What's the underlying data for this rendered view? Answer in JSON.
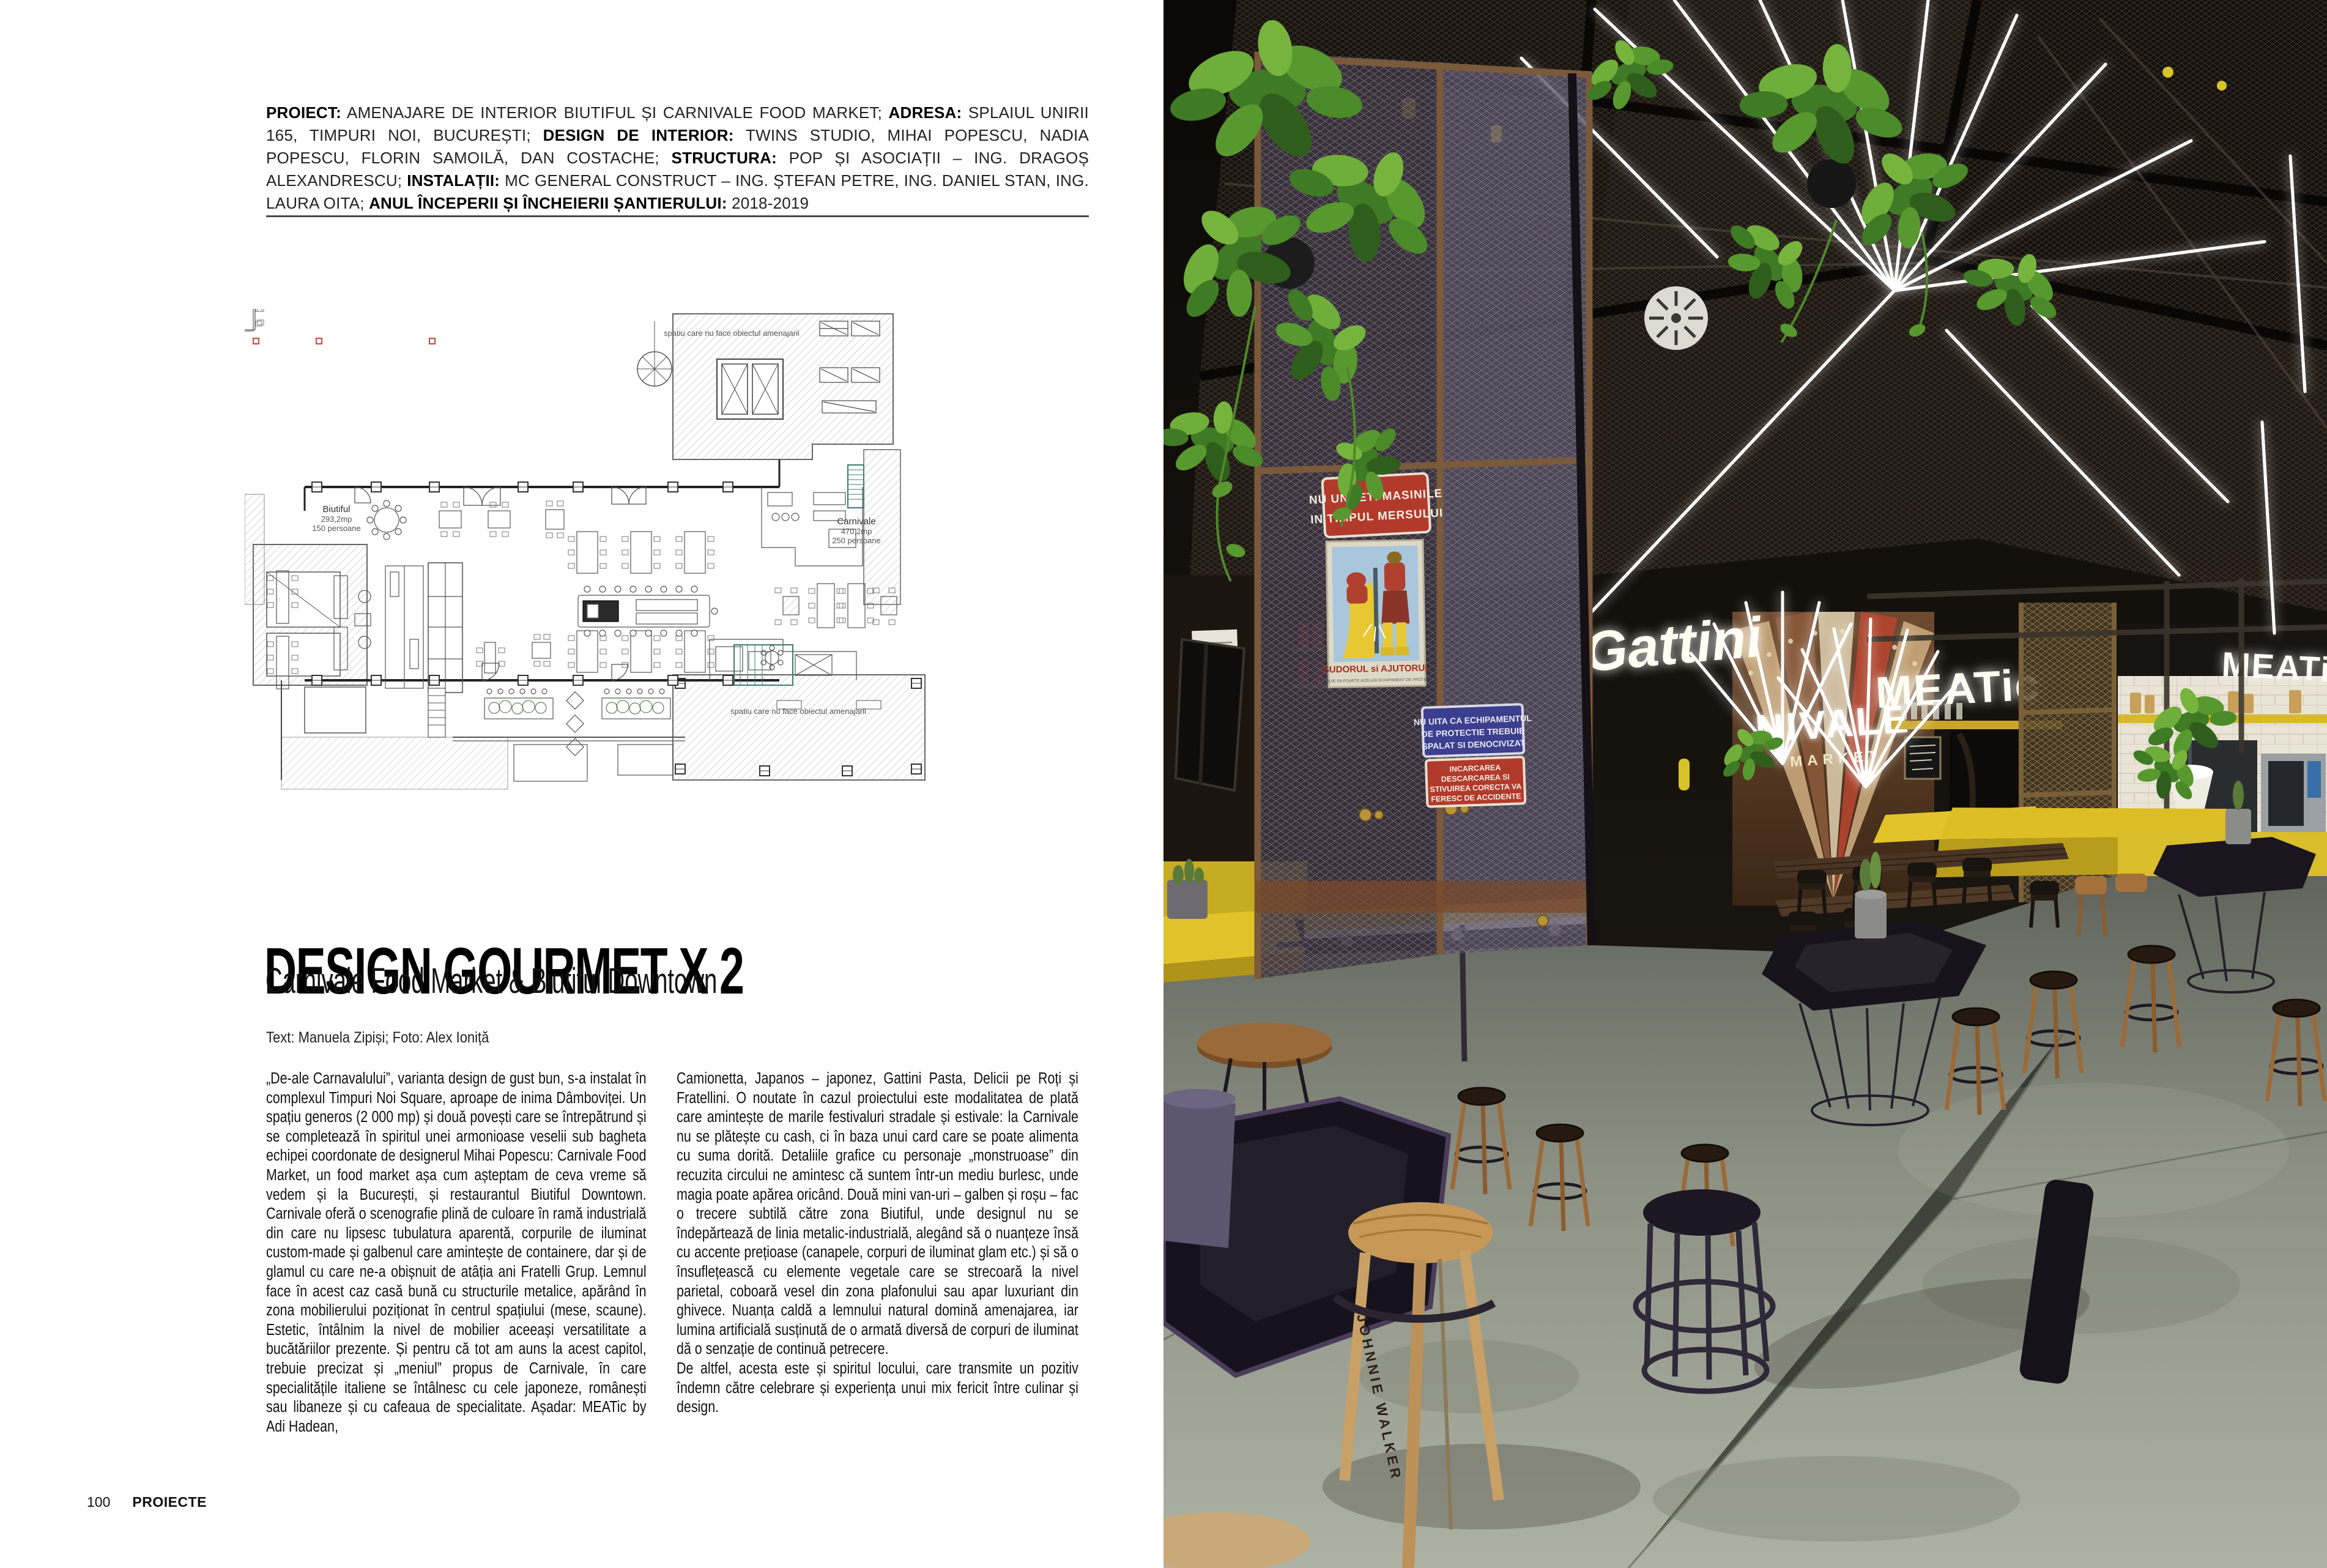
{
  "article": {
    "credits": {
      "segments": [
        {
          "label": "PROIECT:",
          "value": " AMENAJARE DE INTERIOR  BIUTIFUL ȘI CARNIVALE FOOD MARKET; "
        },
        {
          "label": "ADRESA:",
          "value": " SPLAIUL UNIRII 165, TIMPURI NOI, BUCUREȘTI; "
        },
        {
          "label": "DESIGN DE INTERIOR:",
          "value": " TWINS STUDIO, MIHAI POPESCU, NADIA POPESCU, FLORIN SAMOILĂ, DAN COSTACHE; "
        },
        {
          "label": "STRUCTURA:",
          "value": " POP ȘI ASOCIAȚII – ING. DRAGOȘ ALEXANDRESCU; "
        },
        {
          "label": "INSTALAȚII:",
          "value": " MC GENERAL CONSTRUCT – ING. ȘTEFAN PETRE, ING. DANIEL STAN, ING. LAURA OITA; "
        },
        {
          "label": "ANUL ÎNCEPERII ȘI ÎNCHEIERII ȘANTIERULUI:",
          "value": " 2018-2019"
        }
      ]
    },
    "title": "DESIGN GOURMET X 2",
    "subtitle": "Carnivale Food Market & Biutiful Downtown",
    "byline": "Text: Manuela Zipiși; Foto: Alex Ioniță",
    "body": {
      "col1": "„De-ale Carnavalului”, varianta design de gust bun, s-a instalat în complexul Timpuri Noi Square, aproape de inima Dâmboviței. Un spațiu generos (2 000 mp) și două povești care se întrepătrund și se completează în spiritul unei armonioase veselii sub bagheta echipei coordonate de designerul Mihai Popescu: Carnivale Food Market, un food market așa cum așteptam de ceva vreme să vedem și la București, și restaurantul Biutiful Downtown. Carnivale oferă o scenografie plină de culoare în ramă industrială din care nu lipsesc tubulatura aparentă, corpurile de iluminat custom-made și galbenul care amintește de containere, dar și de glamul cu care ne-a obișnuit de atâția ani Fratelli Grup. Lemnul face în acest caz casă bună cu structurile metalice, apărând în zona mobilierului poziționat în centrul spațiului (mese, scaune). Estetic, întâlnim la nivel de mobilier aceeași versatilitate a bucătăriilor prezente. Și pentru că tot am auns la acest capitol, trebuie precizat și „meniul” propus de Carnivale, în care specialitățile italiene se întâlnesc cu cele japoneze, românești sau libaneze și cu cafeaua de specialitate. Așadar: MEATic by Adi Hadean,",
      "col2": "Camionetta, Japanos – japonez, Gattini Pasta, Delicii pe Roți și Fratellini. O noutate în cazul proiectului este modalitatea de plată care amintește de marile festivaluri stradale și estivale: la Carnivale nu se plătește cu cash, ci în baza unui card care se poate alimenta cu suma dorită. Detaliile grafice cu personaje „monstruoase” din recuzita circului ne amintesc că suntem într-un mediu burlesc, unde magia poate apărea oricând. Două mini van-uri – galben și roșu – fac o trecere subtilă către zona Biutiful, unde designul nu se îndepărtează de linia metalic-industrială, alegând să o nuanțeze însă cu accente prețioase (canapele, corpuri de iluminat glam etc.) și să o însuflețească cu elemente vegetale care se strecoară la nivel parietal, coboară vesel din zona plafonului sau apar luxuriant din ghivece. Nuanța caldă a lemnului natural domină amenajarea, iar lumina artificială susținută de o armată diversă de corpuri de iluminat dă o senzație de continuă petrecere.\nDe altfel, acesta este și spiritul locului, care transmite un pozitiv îndemn către celebrare și experiența unui mix fericit între culinar și design."
    },
    "footer": {
      "page_number": "100",
      "section": "PROIECTE"
    }
  },
  "plan": {
    "labels": {
      "out_of_scope": "spatiu care nu face obiectul amenajarii",
      "biutiful_name": "Biutiful",
      "biutiful_area": "293,2mp",
      "biutiful_cap": "150 persoane",
      "carnivale_name": "Carnivale",
      "carnivale_area": "470,2mp",
      "carnivale_cap": "250 persoane"
    }
  },
  "photo": {
    "signs": {
      "no_grease": {
        "line1": "NU UNGETI MASINILE",
        "line2": "IN TIMPUL MERSULUI"
      },
      "poster": {
        "caption": "SUDORUL si AJUTORUL",
        "subcaption": "TREBUIE SA POARTE ACELASI ECHIPAMENT DE PROTECTIE"
      },
      "equipment": {
        "line1": "NU UITA CA ECHIPAMENTUL",
        "line2": "DE PROTECTIE TREBUIE",
        "line3": "SPALAT SI DENOCIVIZAT"
      },
      "loading": {
        "line1": "INCARCAREA",
        "line2": "DESCARCAREA SI",
        "line3": "STIVUIREA CORECTA VA",
        "line4": "FERESC DE ACCIDENTE"
      }
    },
    "neon": {
      "meatic": "MEATic",
      "gattini": "Gattini",
      "carnivale_line1": "NIVALE",
      "carnivale_line2": "MARKET"
    },
    "stool_brand": "JOHNNIE WALKER",
    "colors": {
      "accent_yellow": "#e3c32a",
      "sign_red": "#b23a2c",
      "sign_blue": "#3c3f8e",
      "plant_green": "#58992f",
      "neon_white": "#ffffff"
    }
  }
}
